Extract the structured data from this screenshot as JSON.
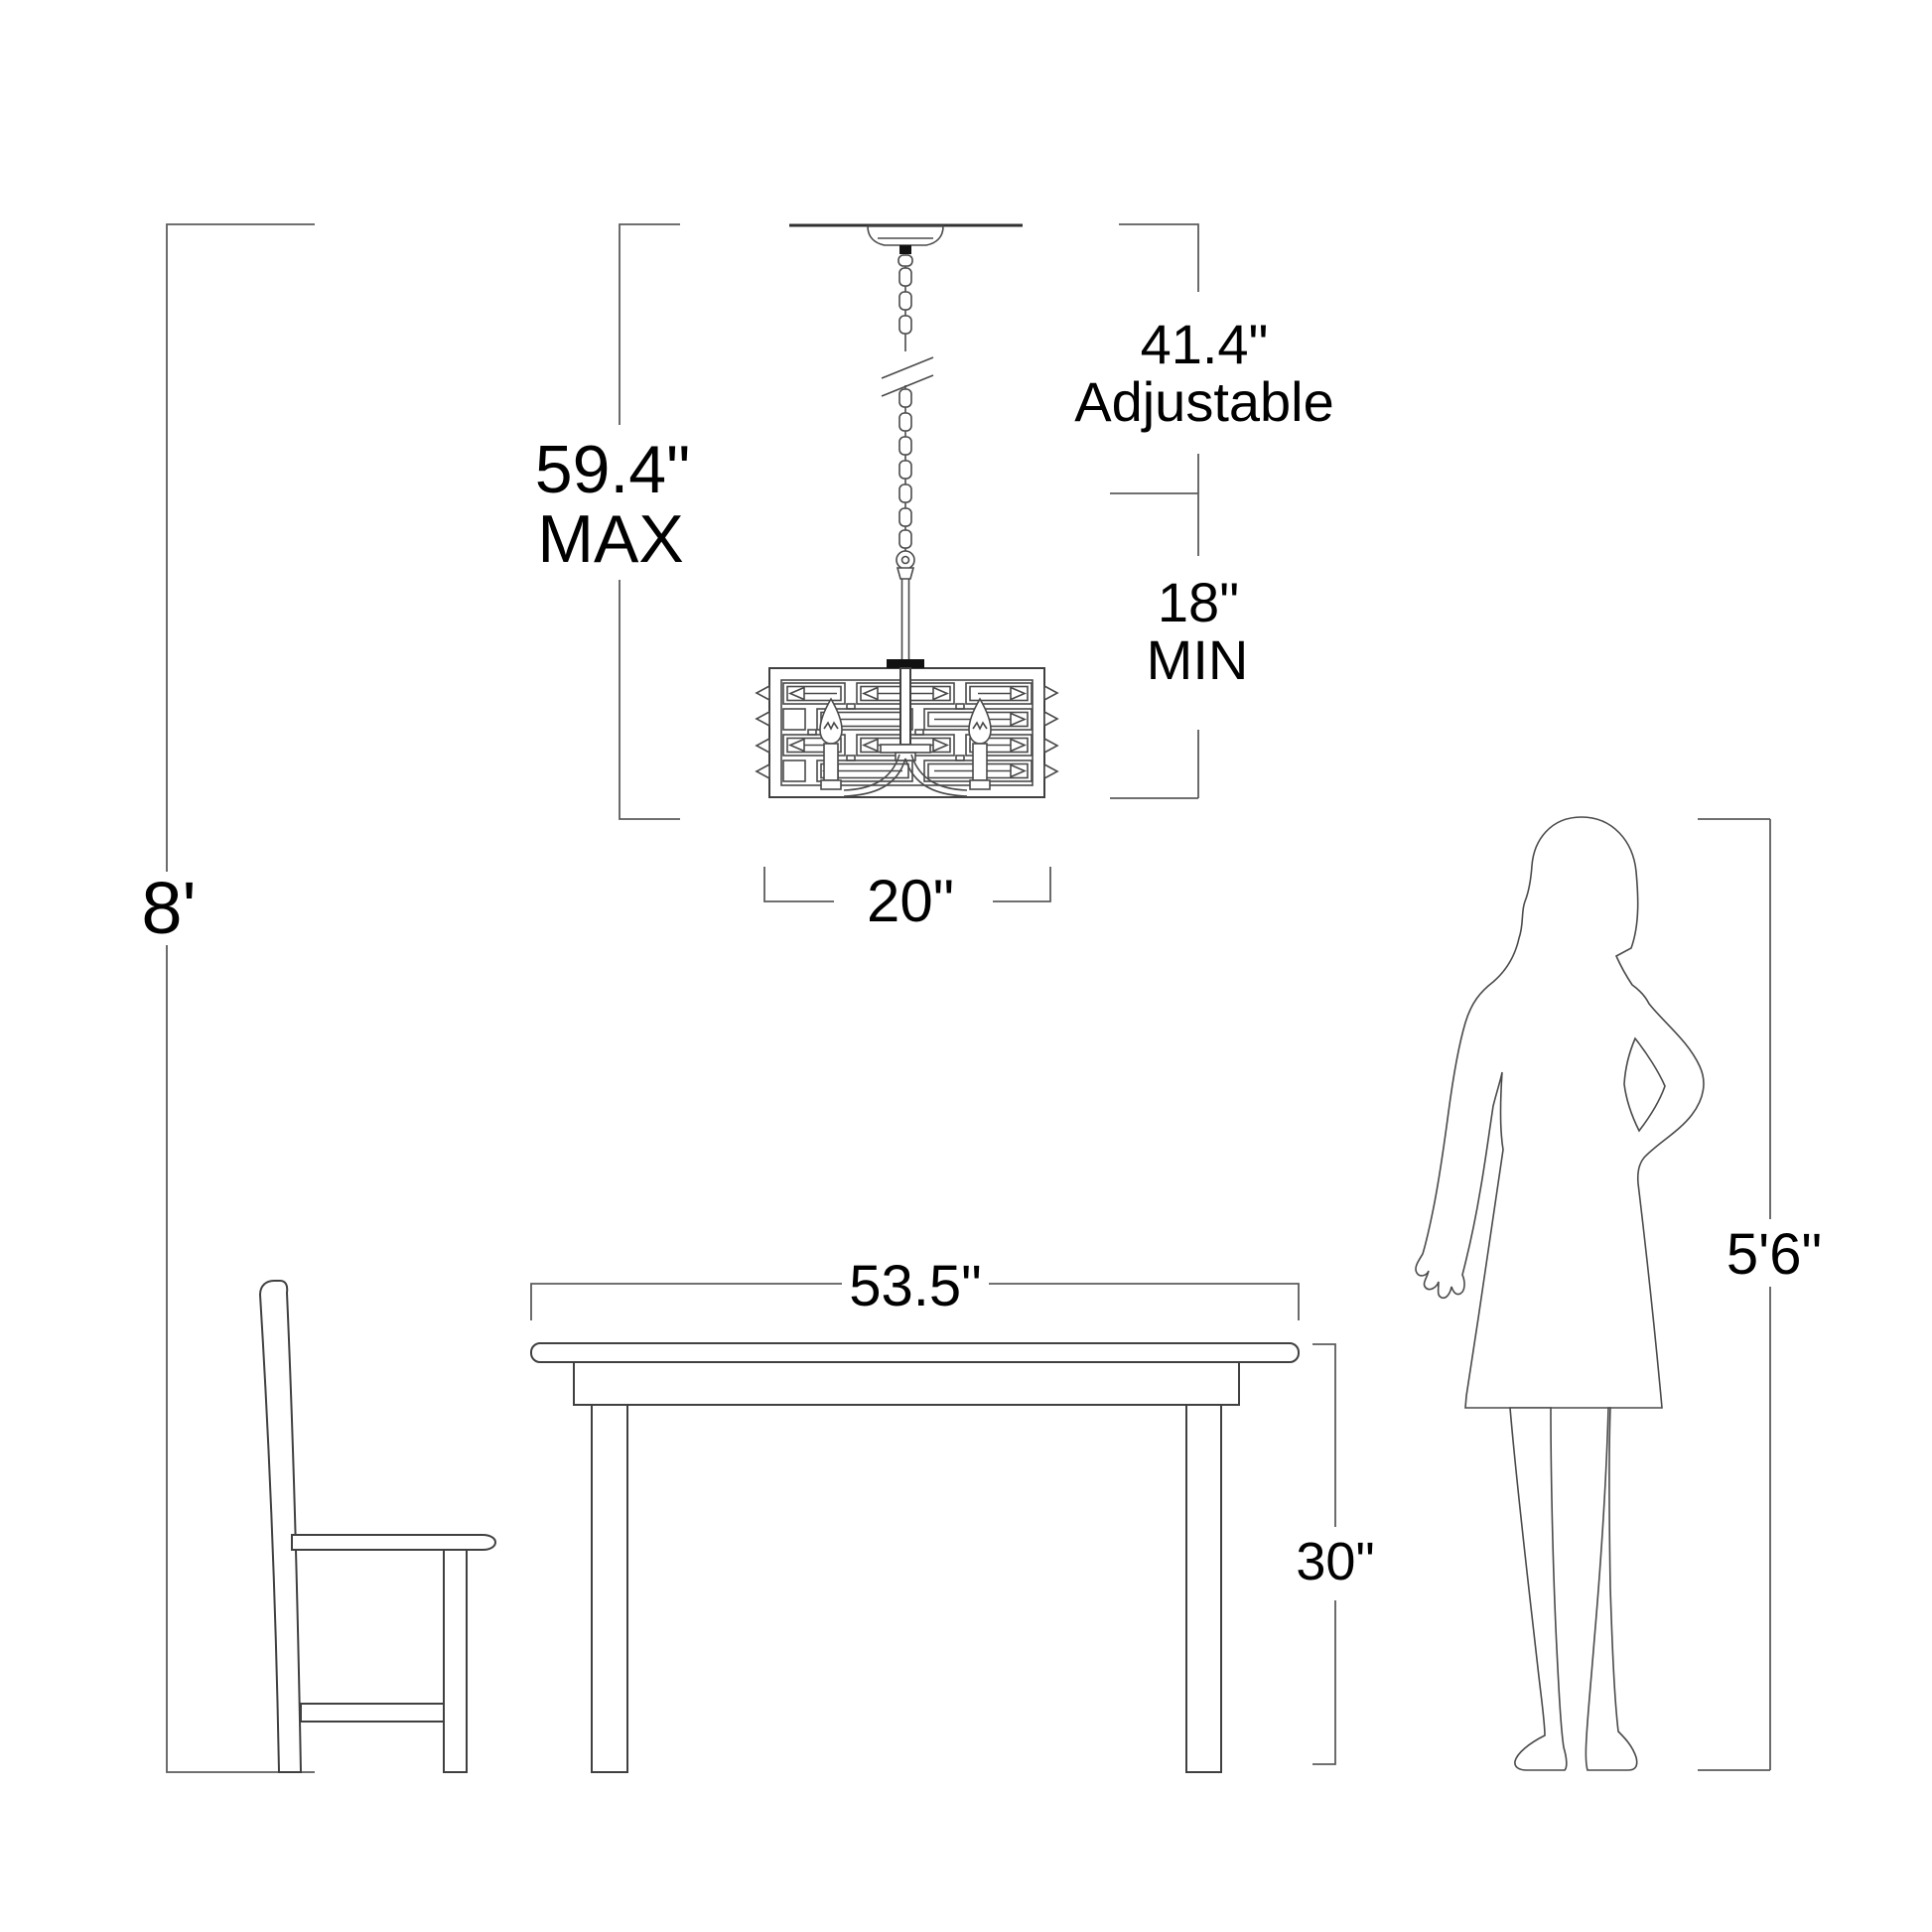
{
  "figure": {
    "type": "product-dimension-diagram",
    "subject": "chandelier hanging from ceiling over dining table with chair and woman silhouette for scale"
  },
  "colors": {
    "background": "#ffffff",
    "line": "#404040",
    "dimension_line": "#5c5c5c",
    "label_text": "#000000"
  },
  "labels": {
    "ceiling_height": "8'",
    "fixture_max_value": "59.4\"",
    "fixture_max_caption": "MAX",
    "adjustable_value": "41.4\"",
    "adjustable_caption": "Adjustable",
    "min_value": "18\"",
    "min_caption": "MIN",
    "shade_width": "20\"",
    "table_width": "53.5\"",
    "table_height": "30\"",
    "person_height": "5'6\""
  }
}
